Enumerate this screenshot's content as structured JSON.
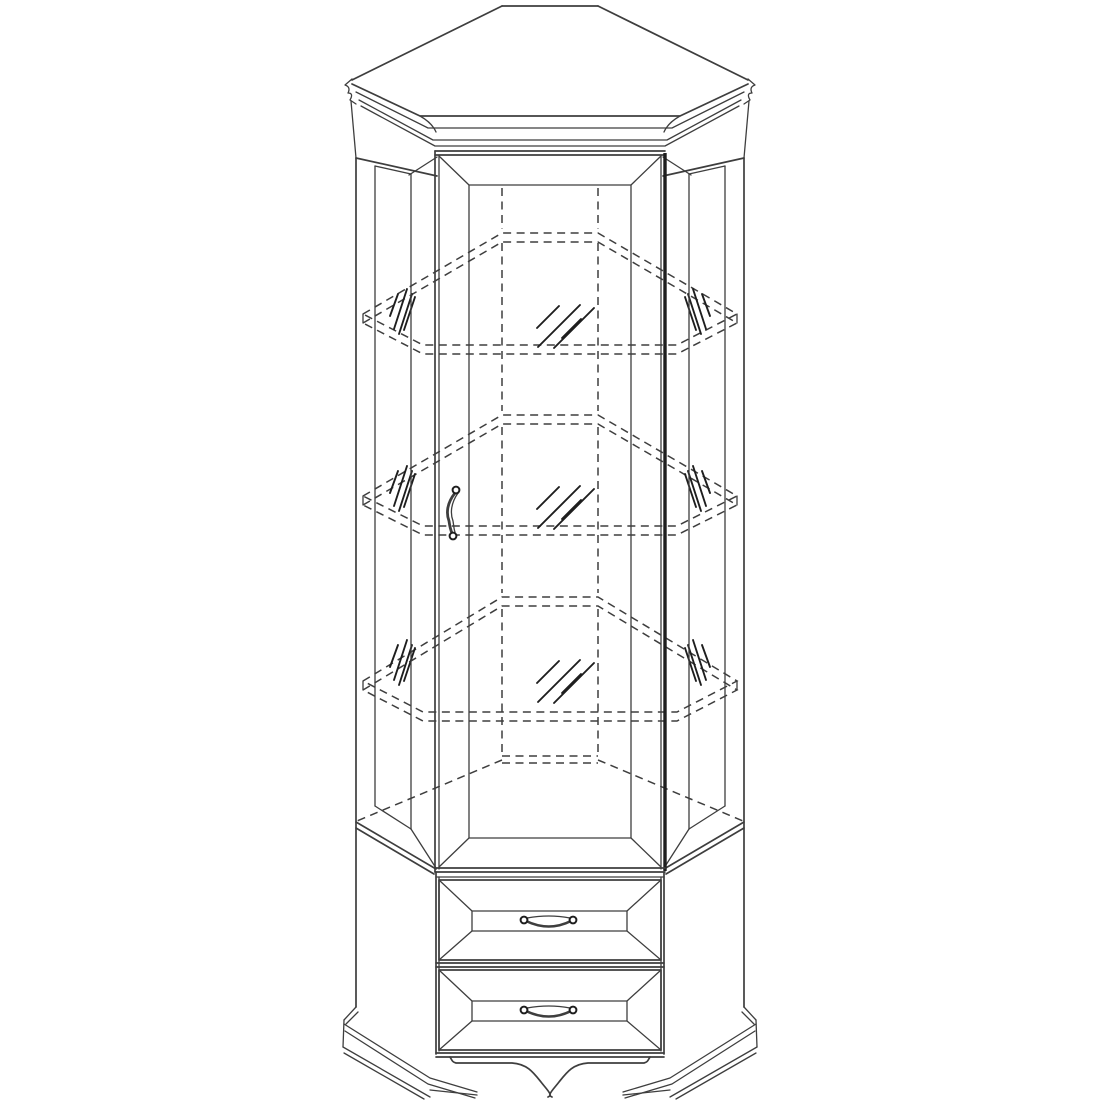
{
  "document": {
    "title": "Corner display cabinet — technical line drawing",
    "type": "furniture-assembly-diagram",
    "visible_text": "none"
  },
  "colors": {
    "background": "#ffffff",
    "line": "#3e3e3e",
    "line_bold": "#1e1e1e"
  },
  "cabinet": {
    "view": "front axonometric, seen slightly from above",
    "sections": {
      "crown": {
        "part": "crown-molding-hood",
        "shape": "angled corner top with peak",
        "tips": 2,
        "molding_bands": 3
      },
      "display": {
        "door": {
          "part": "glass-display-door",
          "panel": "beveled frame panel",
          "handle": "curved vertical pull with two knobs",
          "handle_side": "left",
          "bold_edge_side": "right"
        },
        "side_panels": {
          "count": 2,
          "style": "angled beveled panels"
        },
        "shelves": {
          "count": 3,
          "material": "glass",
          "drawn_as": "hidden dashed outlines with thickness"
        },
        "glass_hatch_groups": 9
      },
      "drawers": {
        "count": 2,
        "front": "beveled raised panel",
        "handles": {
          "count": 2,
          "style": "bow pull with two knobs"
        }
      },
      "base": {
        "part": "molded plinth",
        "style": "bracket feet with arched apron cutout"
      }
    },
    "parts": [
      "crown-molding-hood",
      "left-angled-side-panel",
      "right-angled-side-panel",
      "glass-display-door",
      "door-pull-handle",
      "glass-shelf-top",
      "glass-shelf-middle",
      "glass-shelf-bottom",
      "interior-back-corner-edges",
      "drawer-upper",
      "drawer-lower",
      "drawer-pull-handles",
      "bracket-base-with-arch"
    ]
  }
}
